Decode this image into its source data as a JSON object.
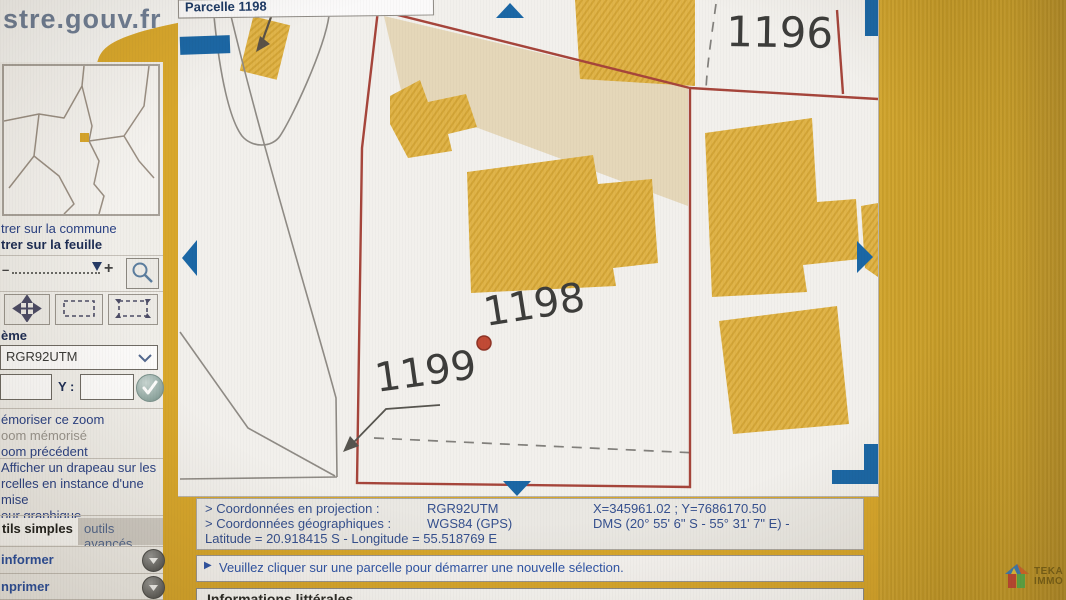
{
  "brand": {
    "logo_text": "stre.gouv.fr"
  },
  "map": {
    "title_bar": "Parcelle 1198",
    "parcel_labels": {
      "p1196": "1196",
      "p1198": "1198",
      "p1199": "1199"
    }
  },
  "sidebar": {
    "center_commune_label": "trer sur la commune",
    "center_feuille_label": "trer sur la feuille",
    "zoom_minus": "–",
    "zoom_plus": "+",
    "system_label": "ème",
    "projection_dropdown_value": "RGR92UTM",
    "y_label": "Y :",
    "memorize_zoom_label": "émoriser ce zoom",
    "zoom_memorized_label": "oom mémorisé",
    "zoom_previous_label": "oom précédent",
    "flag_text_line1": "Afficher un drapeau sur les",
    "flag_text_line2": "rcelles en instance d'une mise",
    "flag_text_line3": "our graphique",
    "tab_simple_tools": "tils simples",
    "tab_advanced_tools": "outils avancés",
    "inform_label": "informer",
    "print_label": "nprimer"
  },
  "coordinates_panel": {
    "projection_label": "> Coordonnées en projection :",
    "projection_system": "RGR92UTM",
    "projection_values": "X=345961.02 ; Y=7686170.50",
    "geographic_label": "> Coordonnées géographiques :",
    "geographic_system": "WGS84 (GPS)",
    "geographic_values": "DMS (20° 55' 6\" S - 55° 31' 7\" E) -",
    "lat_long_line": "Latitude = 20.918415 S - Longitude = 55.518769 E"
  },
  "message_bar": {
    "bullet": "▶",
    "text": "Veuillez cliquer sur une parcelle pour démarrer une nouvelle sélection."
  },
  "bottom_panel": {
    "title": "Informations littérales"
  },
  "watermark": {
    "line1": "TEKA",
    "line2": "IMMO"
  },
  "colors": {
    "page_gold": "#d8a72c",
    "right_band_gold": "#c89d28",
    "parcel_gold": "#dfb244",
    "boundary_red": "#a6453b",
    "nav_arrow_blue": "#1b67a5",
    "link_blue": "#2b4285",
    "selection_dot_red": "#c14a35"
  }
}
